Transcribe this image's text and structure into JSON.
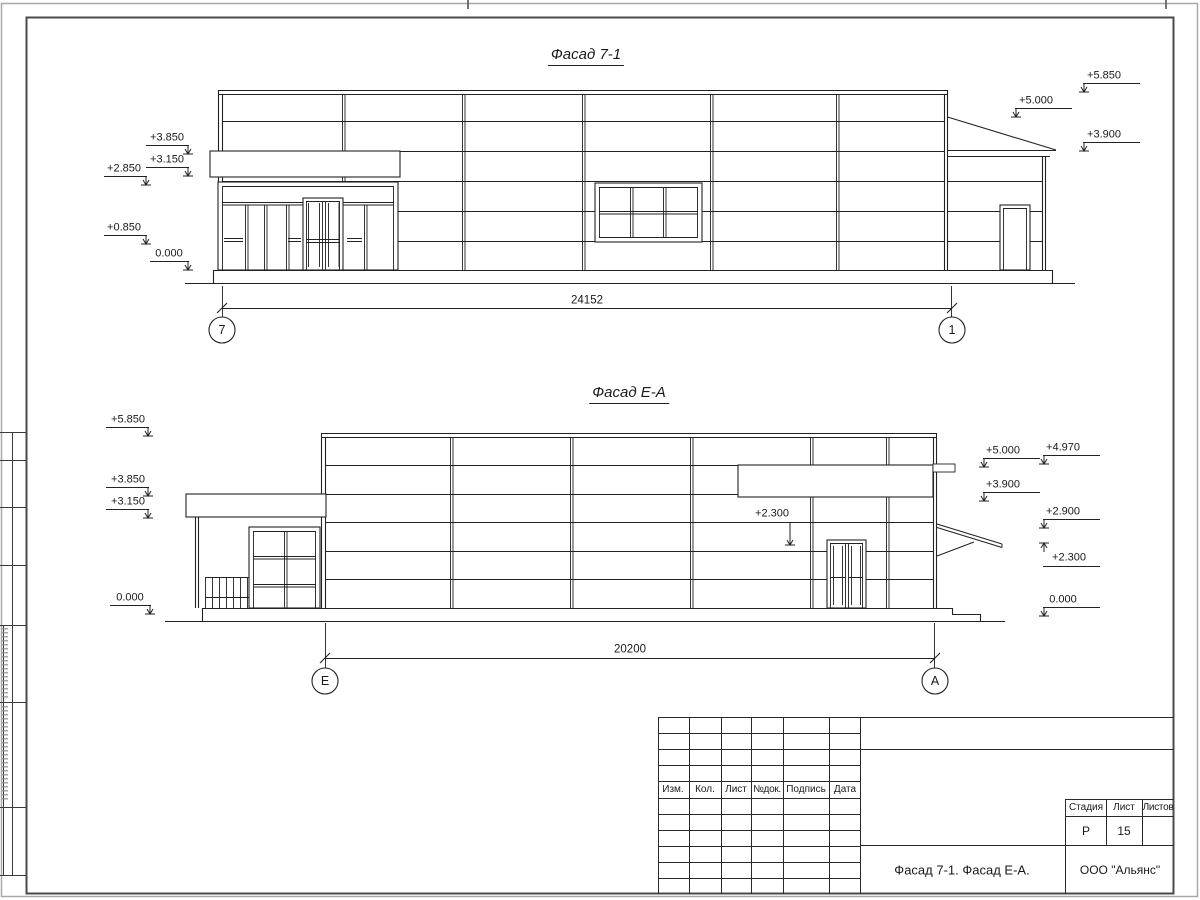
{
  "facade_top": {
    "title": "Фасад 7-1",
    "dimension": "24152",
    "axis_left": "7",
    "axis_right": "1",
    "marks": {
      "m3850": "+3.850",
      "m3150": "+3.150",
      "m2850": "+2.850",
      "m0850": "+0.850",
      "m0000": "0.000",
      "m5850": "+5.850",
      "m5000": "+5.000",
      "m3900": "+3.900"
    }
  },
  "facade_bottom": {
    "title": "Фасад Е-А",
    "dimension": "20200",
    "axis_left": "Е",
    "axis_right": "А",
    "marks": {
      "m5850": "+5.850",
      "m3850": "+3.850",
      "m3150": "+3.150",
      "m0000": "0.000",
      "m5000": "+5.000",
      "m3900": "+3.900",
      "m4970": "+4.970",
      "m2900": "+2.900",
      "m2300": "+2.300",
      "m0000b": "0.000",
      "m2300_canopy": "+2.300"
    }
  },
  "title_block": {
    "rev_columns": [
      "Изм.",
      "Кол.",
      "Лист",
      "№док.",
      "Подпись",
      "Дата"
    ],
    "stage_label": "Стадия",
    "sheet_label": "Лист",
    "sheets_label": "Листов",
    "stage_value": "Р",
    "sheet_value": "15",
    "sheets_value": "",
    "doc_title": "Фасад 7-1. Фасад Е-А.",
    "company": "ООО \"Альянс\""
  }
}
